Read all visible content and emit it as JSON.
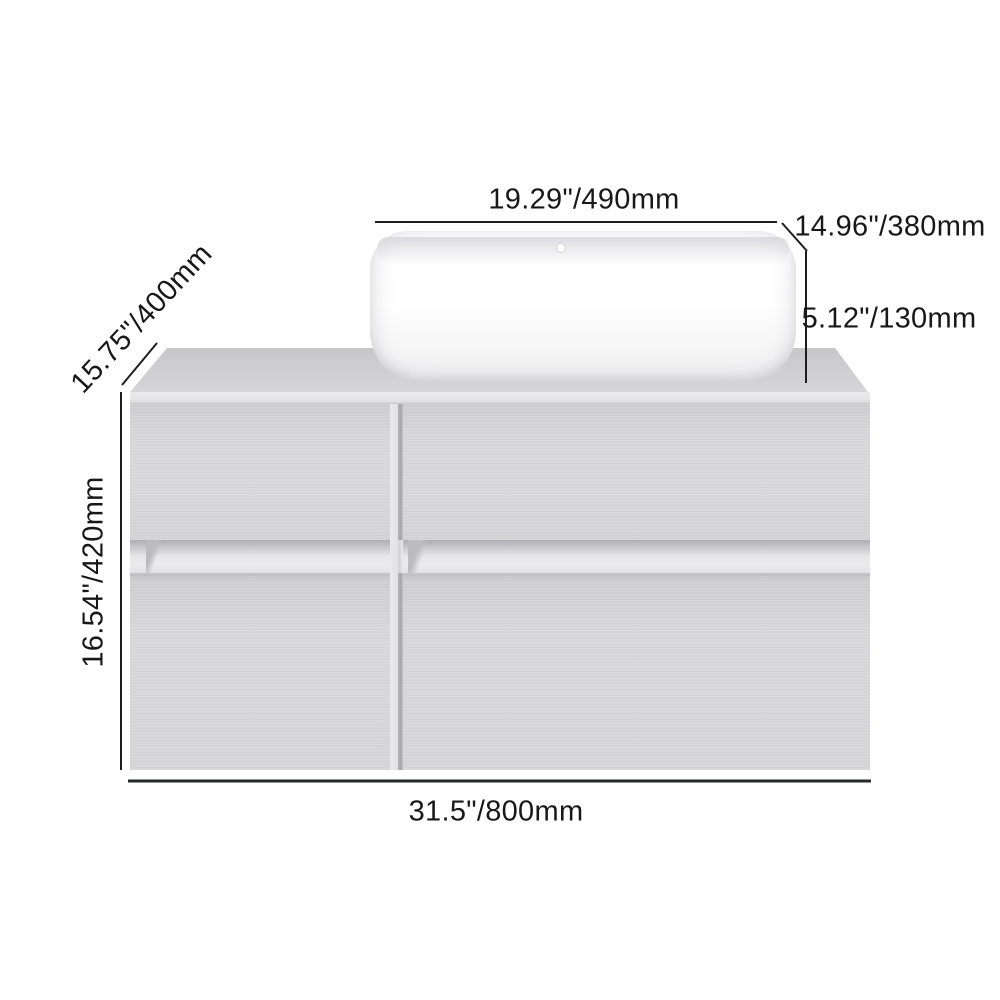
{
  "diagram": {
    "dimensions": {
      "sink_width": "19.29\"/490mm",
      "sink_depth": "14.96\"/380mm",
      "sink_height": "5.12\"/130mm",
      "cabinet_depth": "15.75\"/400mm",
      "cabinet_height": "16.54\"/420mm",
      "cabinet_width": "31.5\"/800mm"
    },
    "colors": {
      "background": "#ffffff",
      "dimension_line": "#1d1d1f",
      "label_text": "#18181a",
      "cabinet_gray": "#d7d7d9",
      "countertop_gray": "#cccccf",
      "groove_gray": "#e9e9eb",
      "divider_shadow_gray": "#a7a7ab",
      "sink_white": "#ffffff"
    }
  }
}
